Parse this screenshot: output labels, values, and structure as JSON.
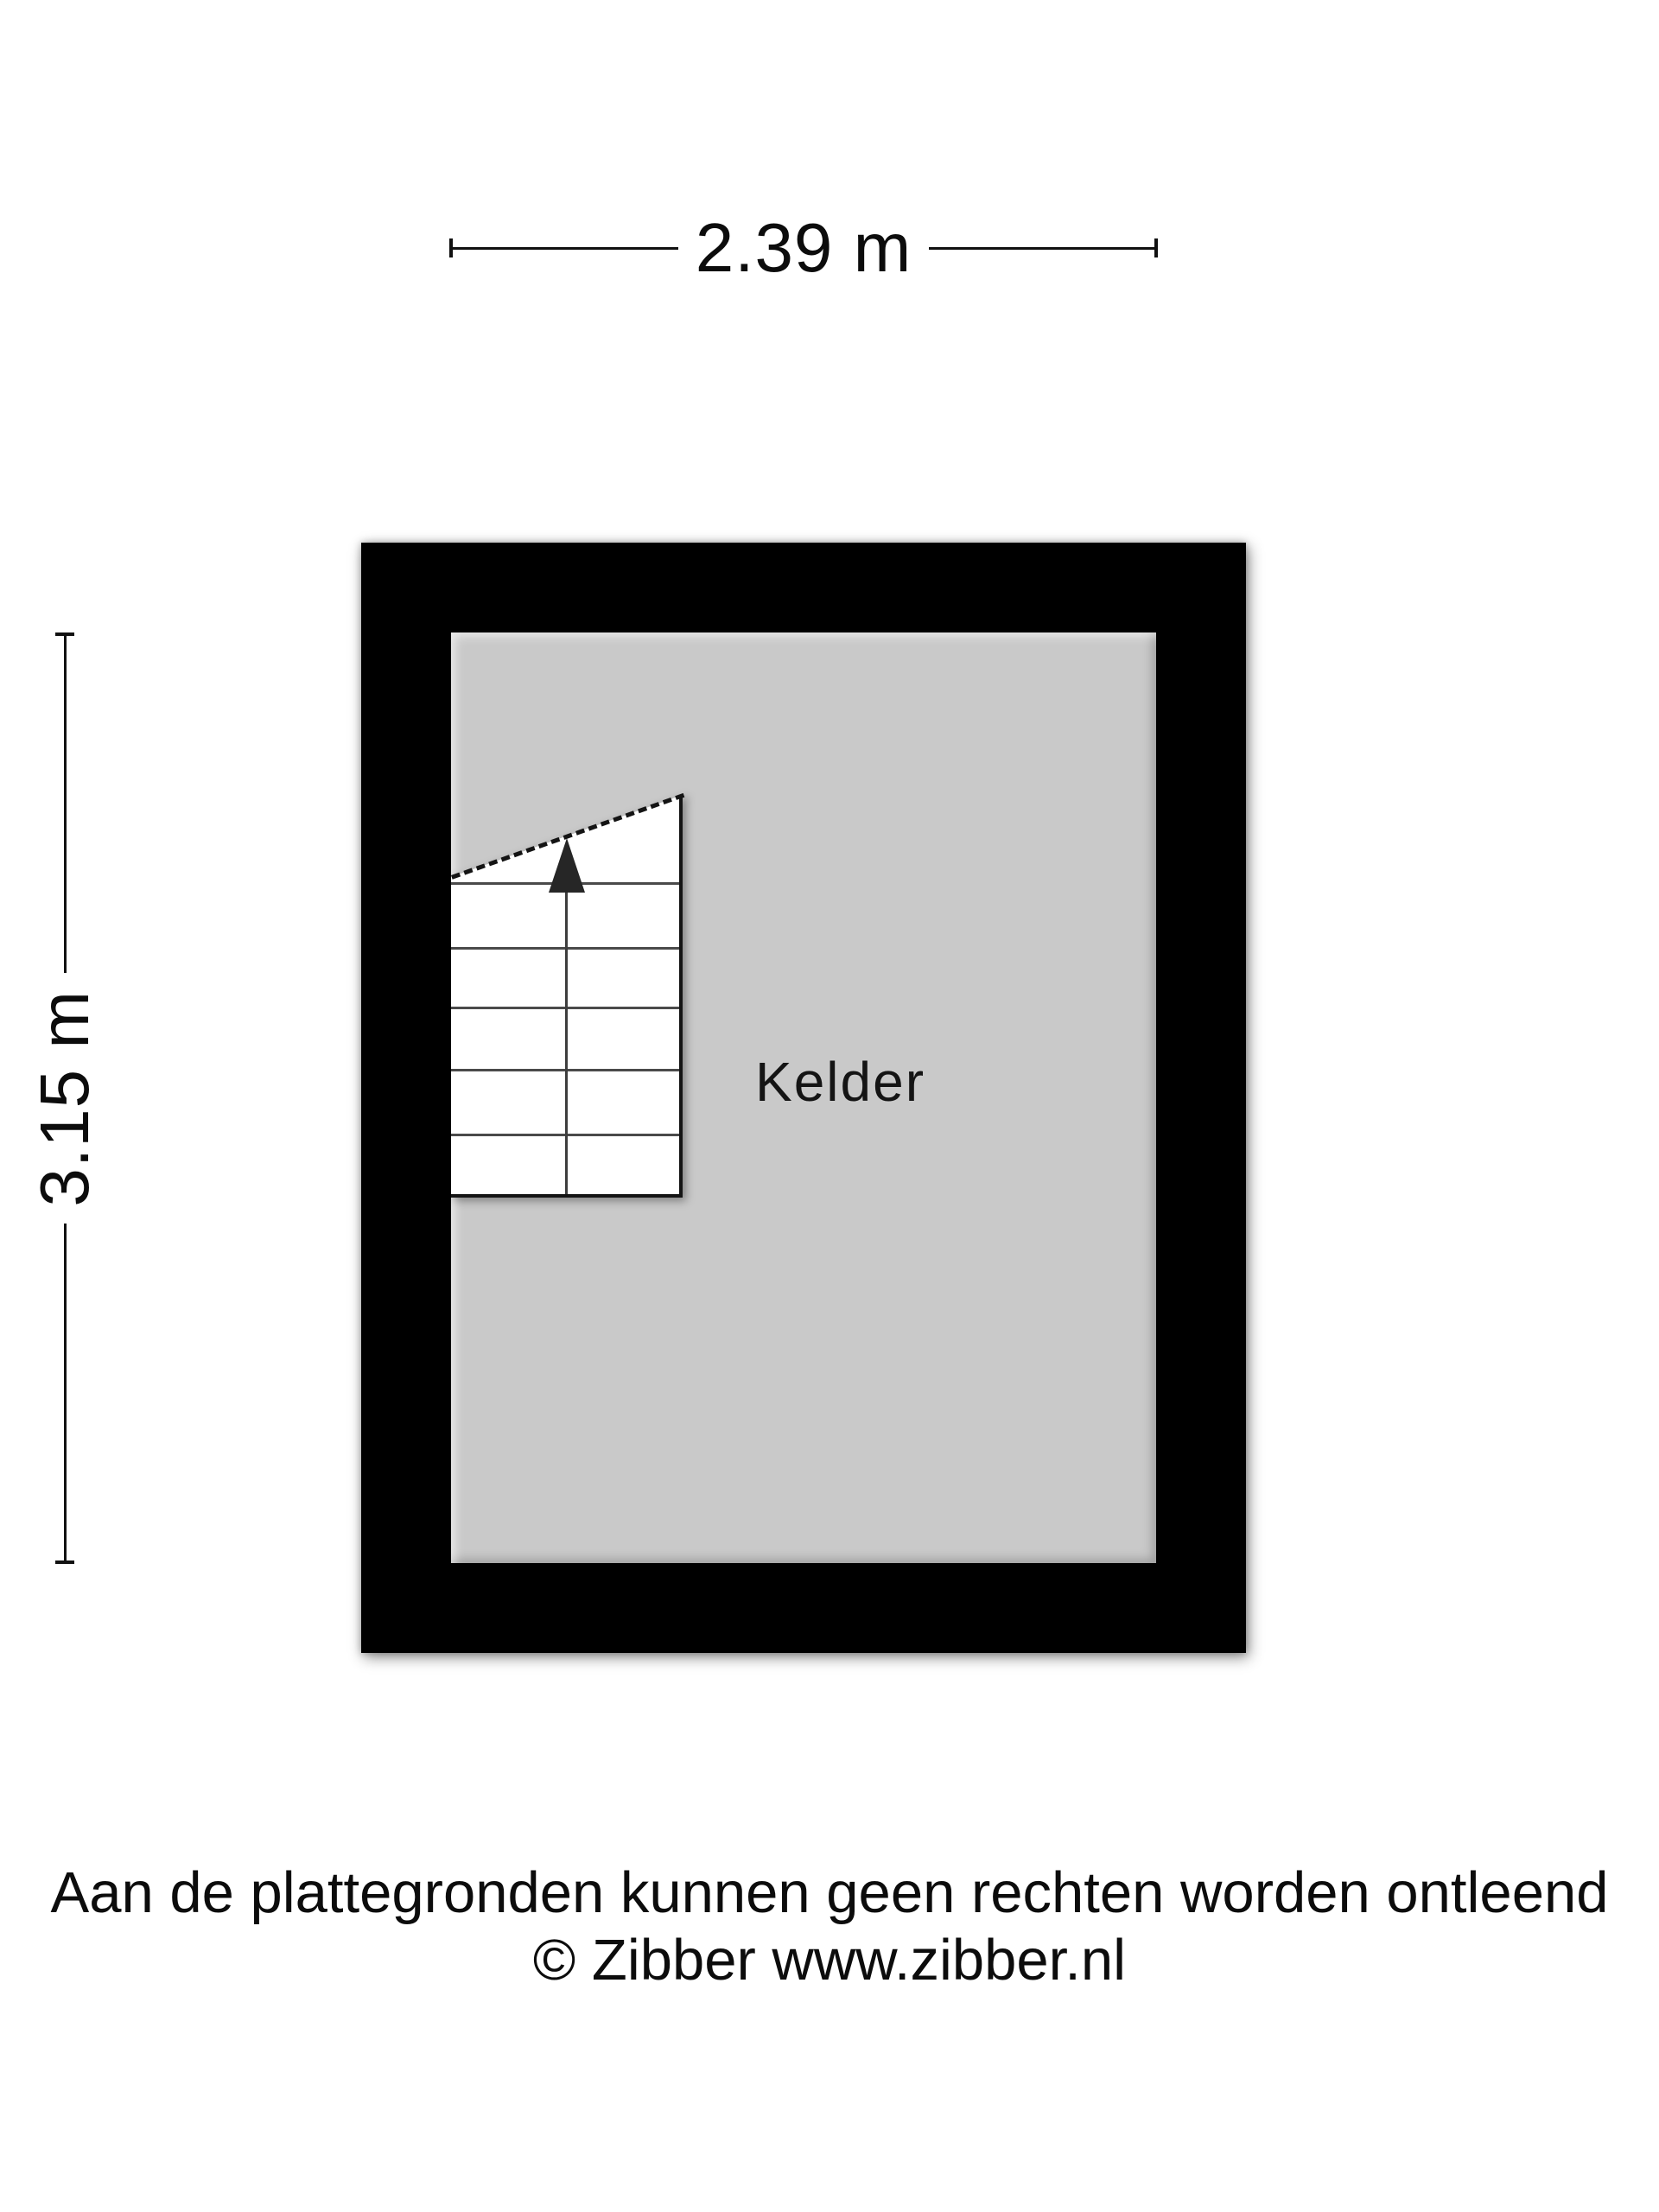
{
  "floorplan": {
    "room": {
      "label": "Kelder"
    },
    "dimensions": {
      "width_label": "2.39 m",
      "height_label": "3.15 m"
    },
    "stairs": {
      "step_count": 5,
      "direction": "up"
    },
    "colors": {
      "wall": "#000000",
      "floor": "#c9c9c9",
      "stair_fill": "#ffffff",
      "line": "#111111"
    }
  },
  "footer": {
    "disclaimer": "Aan de plattegronden kunnen geen rechten worden ontleend",
    "copyright": "© Zibber www.zibber.nl"
  }
}
